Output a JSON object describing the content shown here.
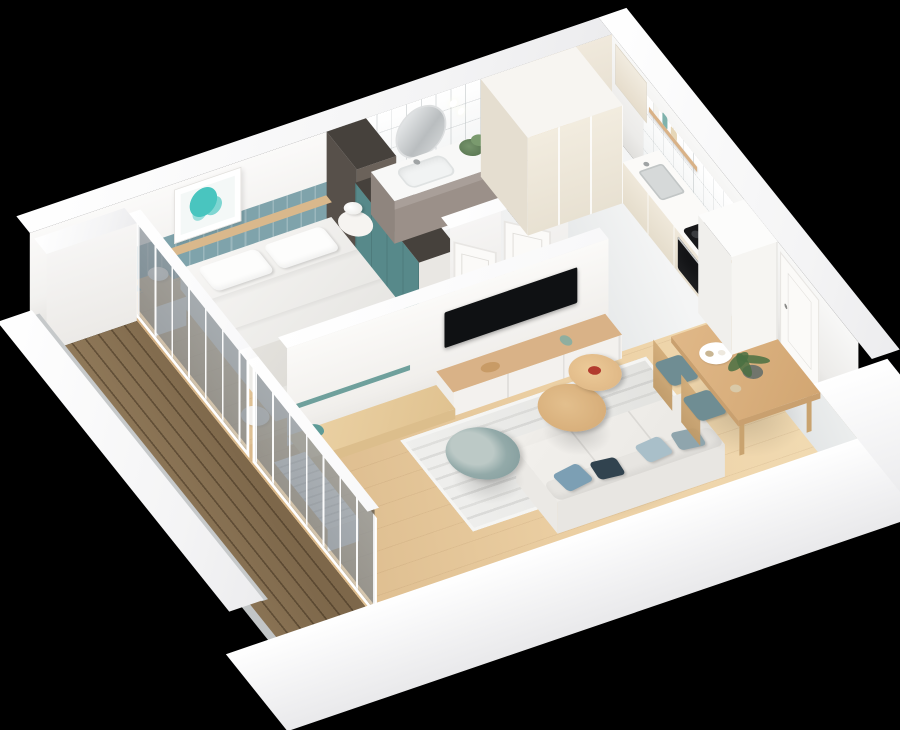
{
  "scene": {
    "title": "3D cutaway render of a one-bedroom apartment floor plan on a black background",
    "view": "isometric bird's-eye cutaway",
    "background": "#000000"
  },
  "palette": {
    "background": "#000000",
    "band-white": "#ffffff",
    "wall-white": "#f5f4f2",
    "wood-floor": "#e0c094",
    "deck-brown": "#8d7657",
    "tile-gray": "#e9eaea",
    "kitchen-gray": "#e6e8e9",
    "accent-teal": "#57898a",
    "wainscot-teal": "#7fa3ab",
    "art-teal": "#49c5bf",
    "wood-furniture": "#d9b287",
    "wood-headboard": "#d9b88c",
    "cream-cabinet": "#f0e9dc",
    "taupe-vanity": "#9b9089",
    "dark-column": "#5b534b",
    "dark-top": "#46413c",
    "appliance-black": "#141517",
    "sofa-cream": "#f0eeea",
    "pillow-blue": "#7c9fb4",
    "pillow-navy": "#31434f",
    "chair-teal": "#6f8d93",
    "armchair-sage": "#8ca4a4",
    "bedding-white": "#f4f3f1",
    "throw-gray": "#e0deda",
    "rug-light": "#ebebe9",
    "plant-green": "#5d7a55",
    "bowl-red": "#b23b2e",
    "mirror-silver": "#c9cdcf"
  },
  "rooms": [
    {
      "name": "bedroom",
      "items": [
        "double bed with white bedding",
        "teal wainscot accent wall",
        "framed teal map artwork",
        "nightstands with white mushroom lamps",
        "teal wardrobe",
        "dark utility column",
        "sliding glass doors to balcony"
      ]
    },
    {
      "name": "bathroom",
      "items": [
        "taupe vanity with white sink",
        "round mirror",
        "wall sconces",
        "potted plant",
        "white tiled walls",
        "open white door"
      ]
    },
    {
      "name": "kitchen",
      "items": [
        "cream tall cabinet columns",
        "white counter with steel sink",
        "black induction cooktop",
        "built-in black oven",
        "wood shelf with jars",
        "cutting boards",
        "gray floor"
      ]
    },
    {
      "name": "living-dining",
      "items": [
        "white fabric sofa with blue and navy pillows",
        "striped light rug",
        "two round wood nesting coffee tables",
        "small red bowl",
        "round sage swivel armchair",
        "TV partition wall with black TV",
        "wood media console",
        "wood step platform with teal watering can",
        "white slatted radiator",
        "wood dining table",
        "two hoop-back chairs with teal seats",
        "potted plant on table"
      ]
    },
    {
      "name": "hallway-entry",
      "items": [
        "white entry door",
        "tall white entry closet",
        "open bedroom door"
      ]
    },
    {
      "name": "balcony",
      "items": [
        "brown plank decking",
        "white parapet wall",
        "glass sliding doors"
      ]
    }
  ]
}
